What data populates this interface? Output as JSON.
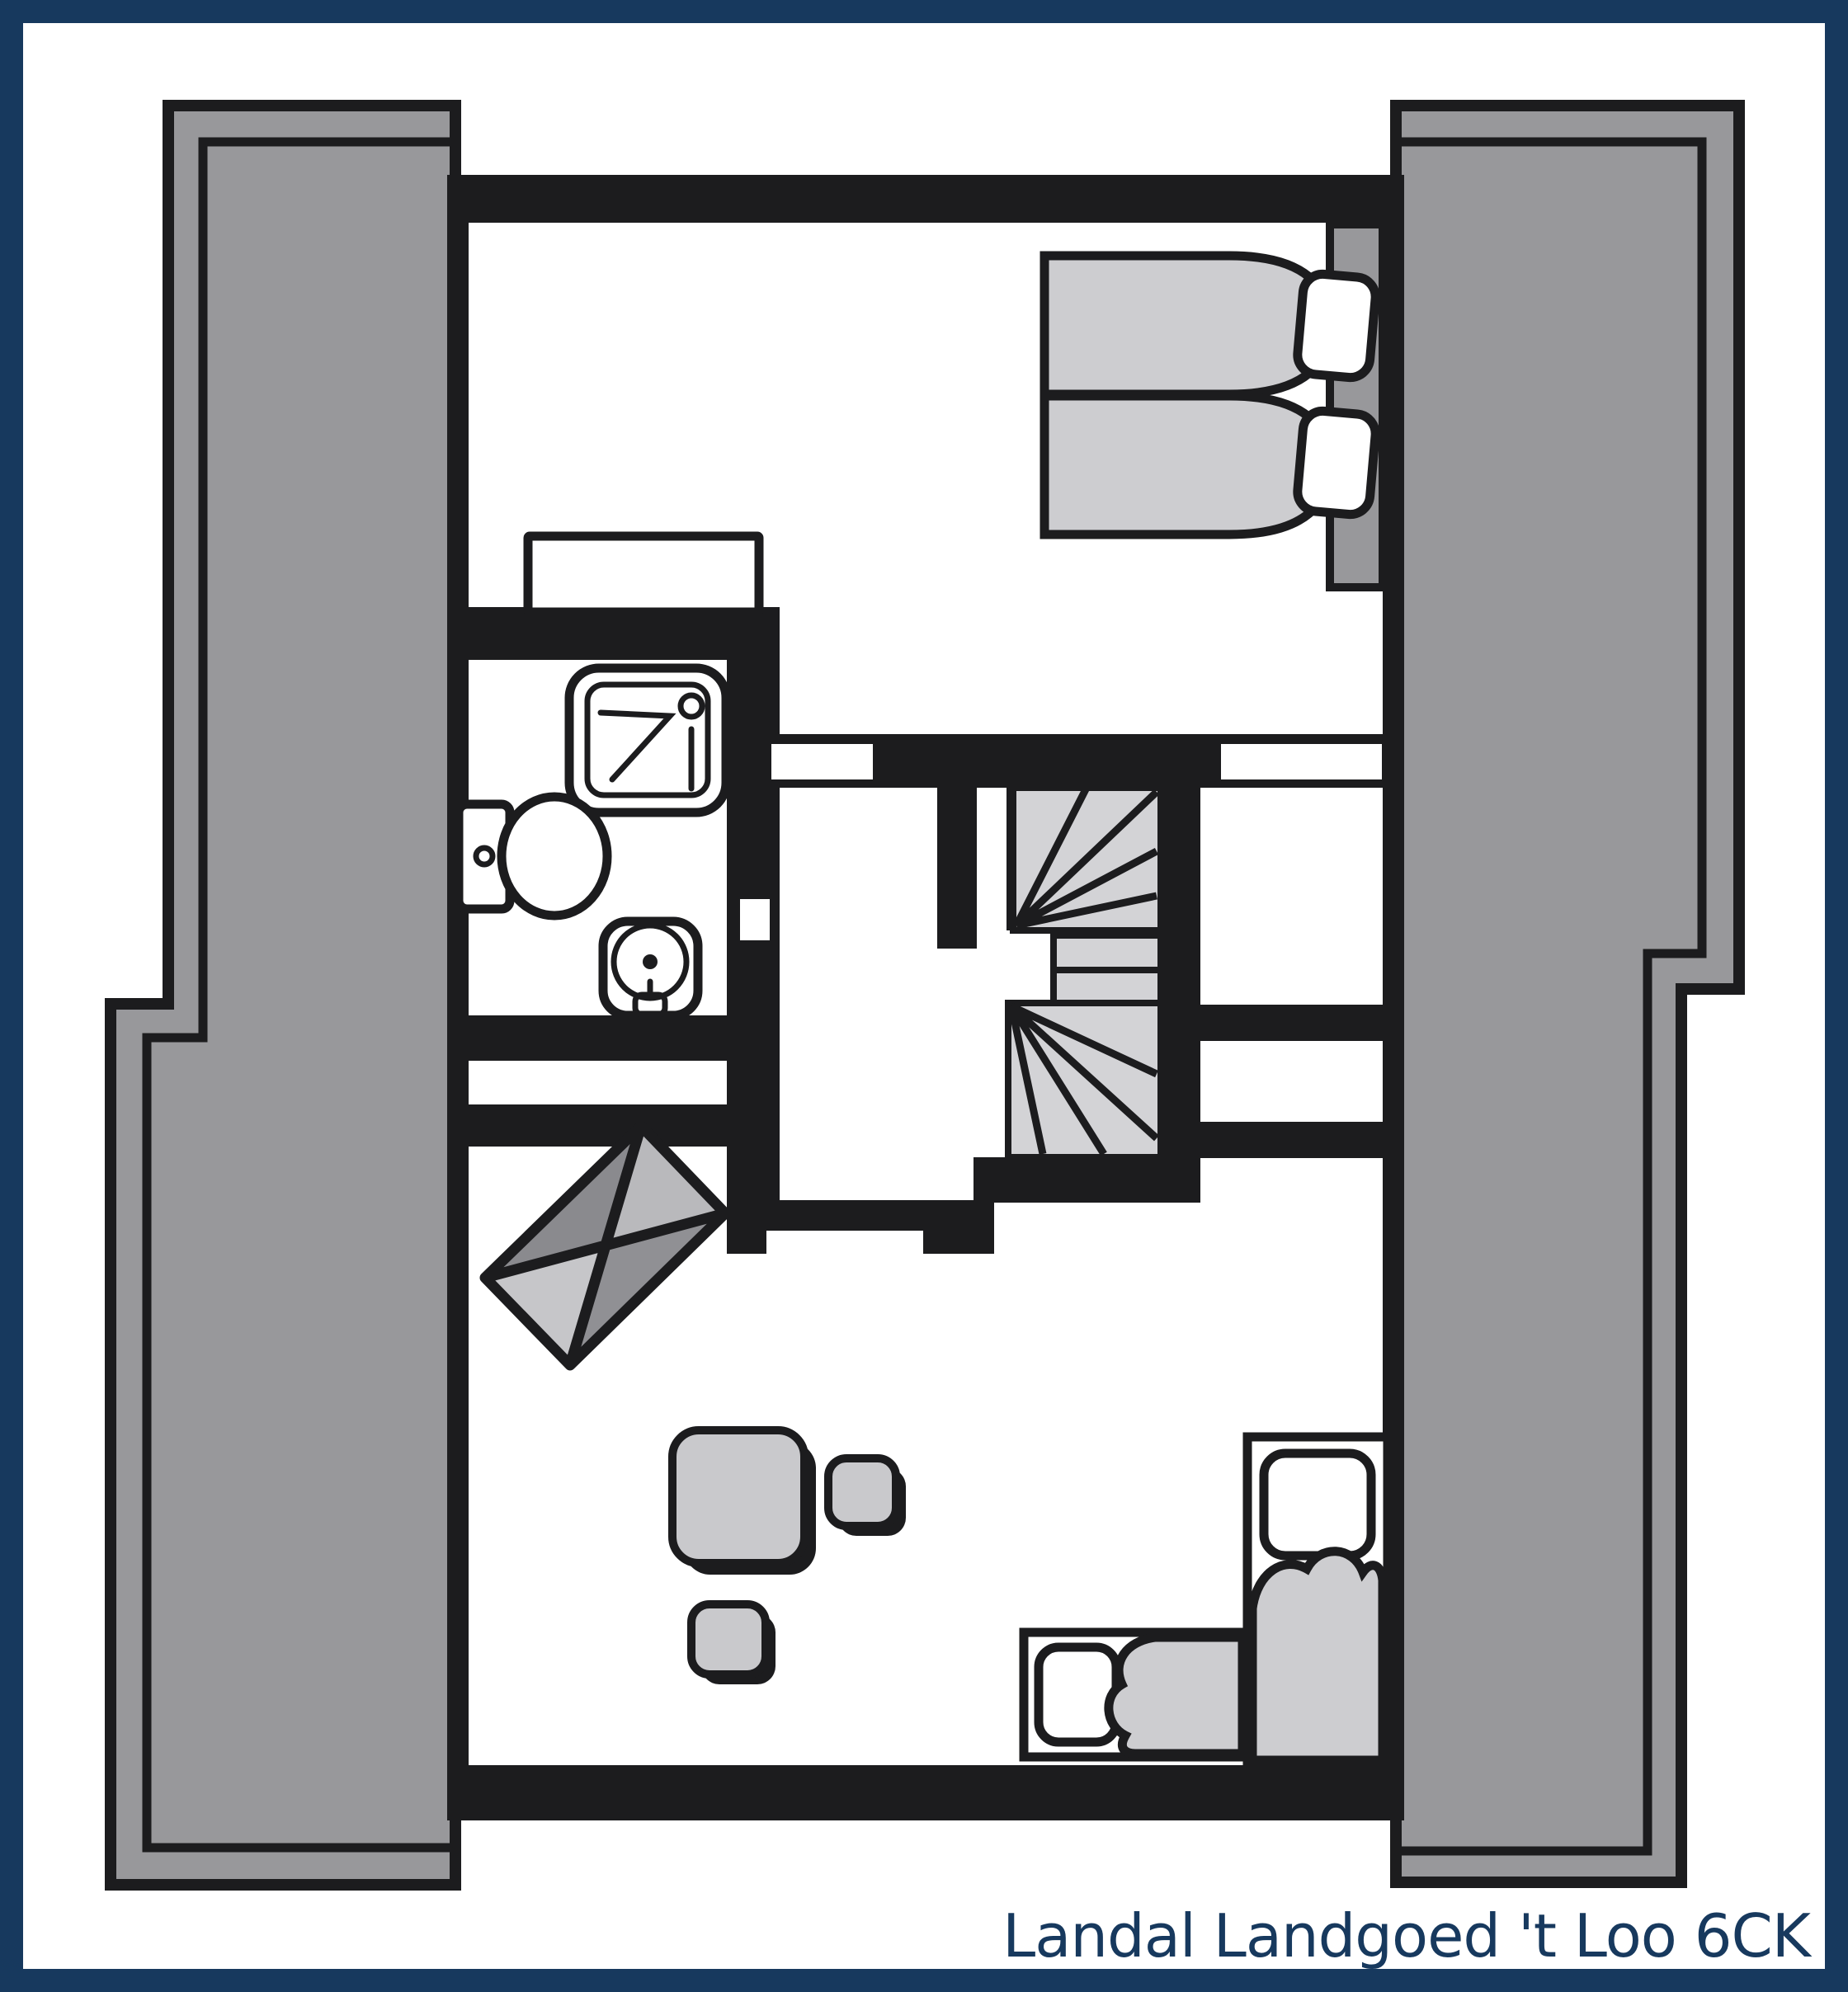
{
  "caption": "Landal Landgoed 't Loo 6CK",
  "colors": {
    "navy": "#17395e",
    "ink": "#1c1c1e",
    "roof": "#98989b",
    "soft": "#cdcdd0",
    "stair": "#d3d3d6",
    "tbl": "#c9c9cc",
    "bg": "#ffffff"
  },
  "symbols": {
    "roof_left": "sloped-roof-area",
    "roof_right": "sloped-roof-area",
    "bedroom_bed": "double-bed-two-mattresses",
    "bathroom": [
      "shower",
      "toilet",
      "washbasin"
    ],
    "staircase": "winding-staircase",
    "living": [
      "side-table",
      "dining-table",
      "stool",
      "stool"
    ],
    "corner_beds": [
      "single-bed-vertical",
      "single-bed-horizontal"
    ],
    "wardrobe": "dresser"
  }
}
